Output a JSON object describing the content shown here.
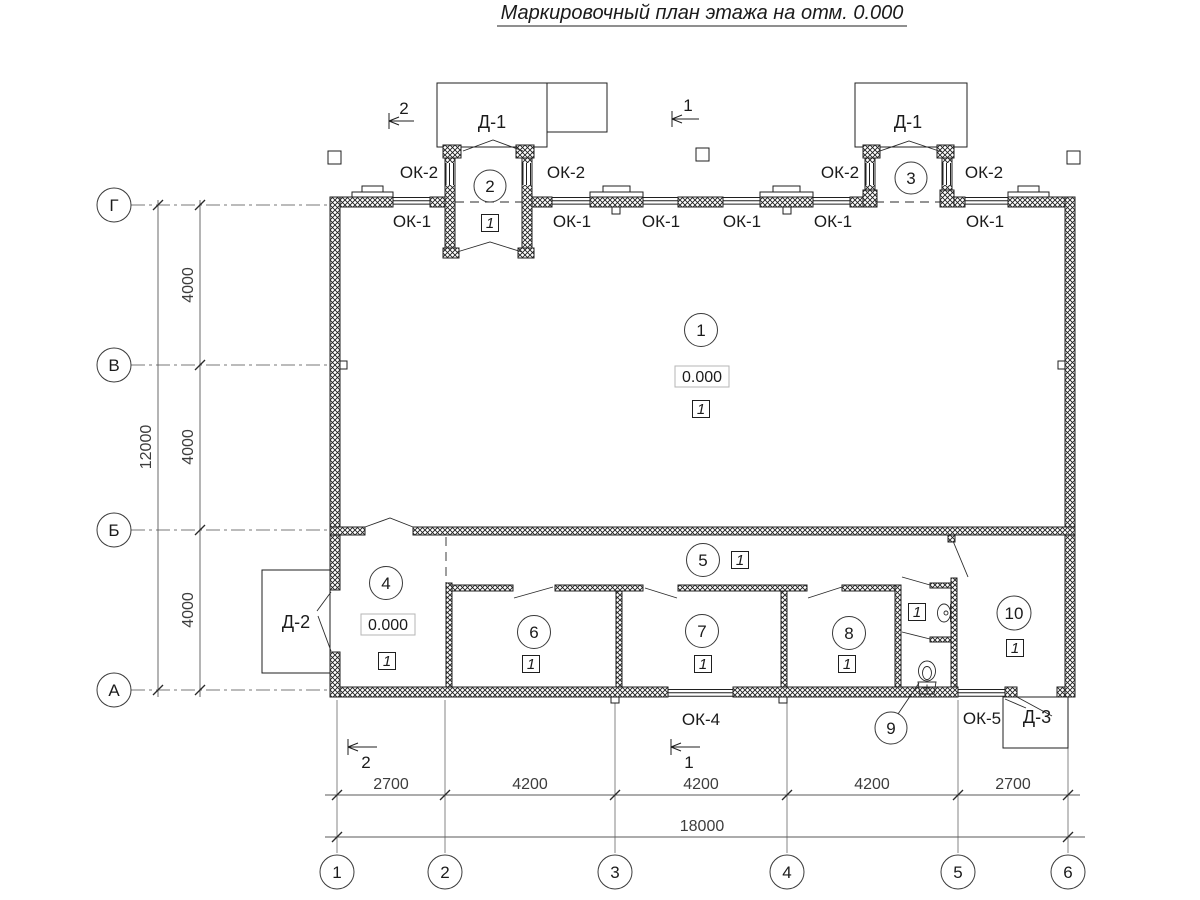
{
  "title": "Маркировочный план этажа на отм. 0.000",
  "grid": {
    "cols": [
      "1",
      "2",
      "3",
      "4",
      "5",
      "6"
    ],
    "rows": [
      "Г",
      "В",
      "Б",
      "А"
    ]
  },
  "dims": {
    "bottom": [
      "2700",
      "4200",
      "4200",
      "4200",
      "2700"
    ],
    "bottom_total": "18000",
    "left": [
      "4000",
      "4000",
      "4000"
    ],
    "left_total": "12000"
  },
  "marks": {
    "window_ok1": "ОК-1",
    "window_ok2": "ОК-2",
    "window_ok4": "ОК-4",
    "window_ok5": "ОК-5",
    "door_d1": "Д-1",
    "door_d2": "Д-2",
    "door_d3": "Д-3",
    "floor_type": "1",
    "elevation": "0.000",
    "section_1": "1",
    "section_2": "2"
  },
  "rooms": [
    "1",
    "2",
    "3",
    "4",
    "5",
    "6",
    "7",
    "8",
    "9",
    "10"
  ]
}
